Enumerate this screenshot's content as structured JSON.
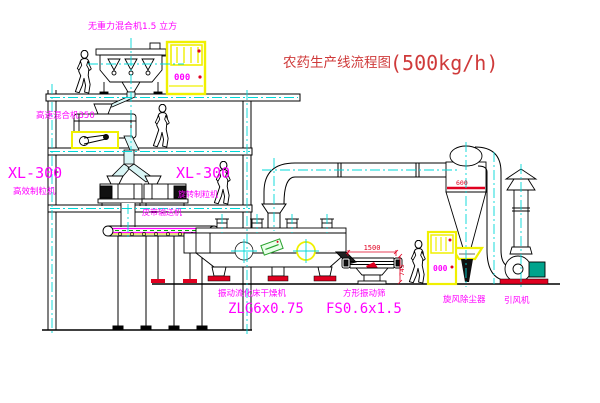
{
  "meta": {
    "width": 600,
    "height": 403,
    "background": "#ffffff",
    "drawing_type": "cad-process-flow-diagram"
  },
  "title": {
    "name": "农药生产线流程图",
    "capacity": "(500kg/h)"
  },
  "equipment_labels": {
    "gravity_free_mixer": "无重力混合机1.5 立方",
    "high_speed_mixer": "高速混合机350",
    "granulator_left": {
      "model": "XL-300",
      "name": "高效制粒机"
    },
    "granulator_right": {
      "model": "XL-300",
      "name": "旋转制粒机"
    },
    "belt_conveyor": "皮带输送机",
    "fluid_bed_dryer": {
      "name": "振动流化床干燥机",
      "model": "ZLG6x0.75"
    },
    "square_vibrating_sieve": {
      "name": "方形振动筛",
      "model": "FS0.6x1.5"
    },
    "cyclone_dust_collector": "旋风除尘器",
    "induced_draft_fan": "引风机"
  },
  "dimensions": {
    "sieve_length": "1500",
    "sieve_height": "745",
    "cyclone_marking": "600"
  },
  "control_cabinets": {
    "top_display": "000",
    "right_display": "000"
  },
  "colors": {
    "line": "#000000",
    "label": "#ff00ff",
    "title": "#cf3a3a",
    "centerline": "#00d8d8",
    "cabinet": "#f0f000",
    "dimension": "#ff0000",
    "motor_green": "#00a38c",
    "sticker_green": "#27a02c",
    "chute_fill": "#d9f6f6",
    "conveyor_green": "#00aa00"
  }
}
